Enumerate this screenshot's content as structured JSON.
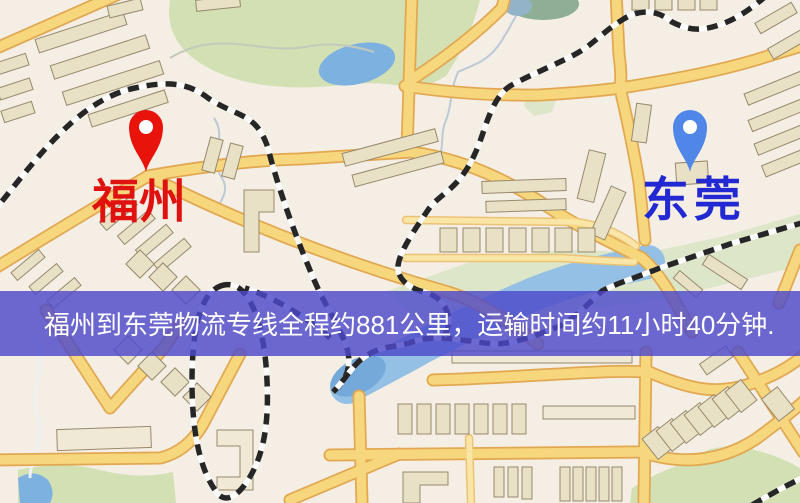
{
  "meta": {
    "width": 800,
    "height": 503,
    "type": "logistics-route-map"
  },
  "banner": {
    "text": "福州到东莞物流专线全程约881公里，运输时间约11小时40分钟.",
    "bg_color": "#4d49cb",
    "text_color": "#ffffff"
  },
  "markers": {
    "origin": {
      "label": "福州",
      "pin_color": "#e8130a",
      "label_color": "#e01210"
    },
    "destination": {
      "label": "东莞",
      "pin_color": "#4f86e8",
      "label_color": "#2228d2"
    }
  },
  "map_colors": {
    "background": "#f4eee4",
    "road_fill": "#f6d77e",
    "road_casing": "#e2a851",
    "building": "#e9e1c6",
    "park": "#d2e0b4",
    "water": "#7db1e0",
    "railway": "#262626"
  }
}
